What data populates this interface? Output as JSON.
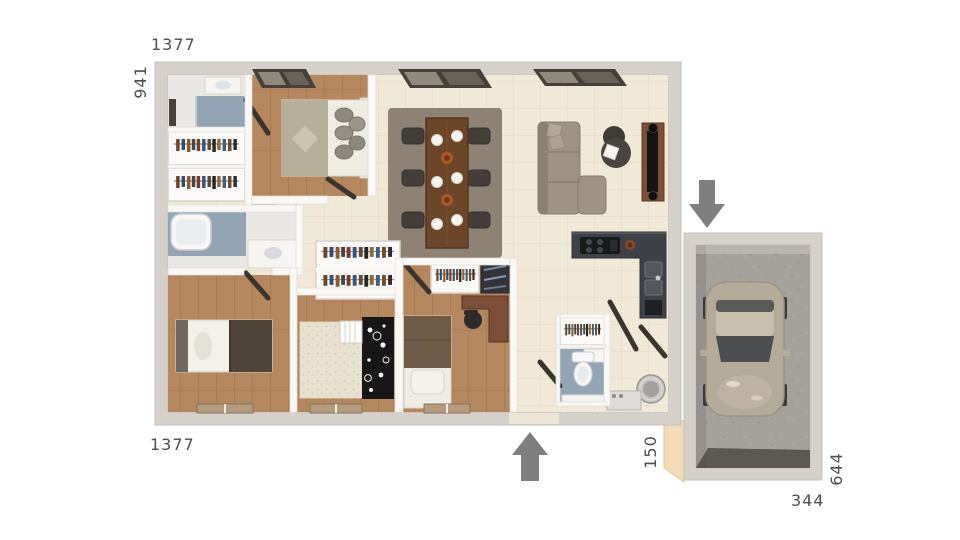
{
  "plan": {
    "dimensions": {
      "top_width": "1377",
      "left_height": "941",
      "bottom_width": "1377",
      "entry_gap": "150",
      "garage_depth": "644",
      "garage_width": "344"
    },
    "arrows": {
      "garage_entry_direction": "down",
      "main_entry_direction": "up"
    },
    "colors": {
      "wall_band": "#d5d0c9",
      "interior_wall": "#f9f8f5",
      "tile_floor": "#f1e9d7",
      "wood_floor": "#b5875f",
      "bath_floor": "#93a4b5",
      "nursery_carpet": "#e9e1d0",
      "dining_rug": "#8e8275",
      "dark_rug": "#171717",
      "sofa": "#9d9284",
      "dining_table": "#6b4628",
      "kitchen_counter": "#3e4248",
      "tv_cabinet": "#7d4e38",
      "garage_floor": "#a5a19b",
      "car_body": "#b4aa99",
      "arrow": "#7f7f7f",
      "dimension_text": "#4e4e4e"
    }
  }
}
